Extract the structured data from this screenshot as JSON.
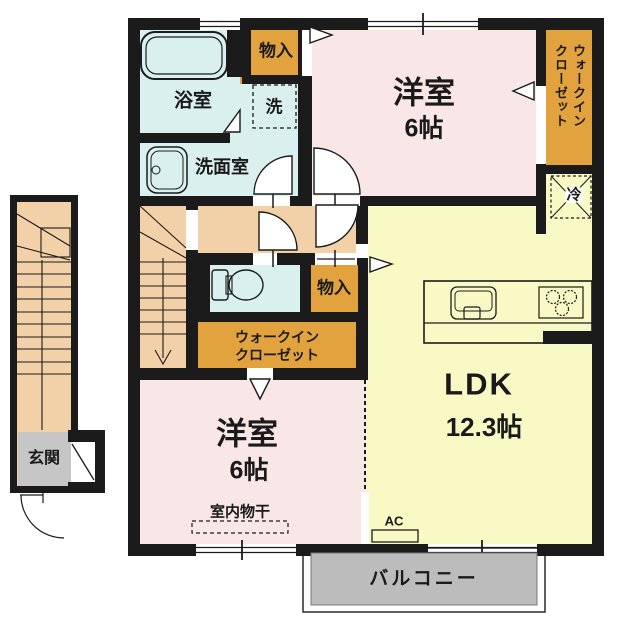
{
  "rooms": {
    "bathroom": {
      "label": "浴室"
    },
    "washer": {
      "label": "洗"
    },
    "storage_top": {
      "label": "物入"
    },
    "washroom": {
      "label": "洗面室"
    },
    "bedroom_top": {
      "name": "洋室",
      "size": "6帖"
    },
    "wic_top": {
      "label": "ウォークインクローゼット"
    },
    "fridge": {
      "label": "冷"
    },
    "storage_mid": {
      "label": "物入"
    },
    "wic_mid": {
      "line1": "ウォークイン",
      "line2": "クローゼット"
    },
    "ldk": {
      "name": "LDK",
      "size": "12.3帖"
    },
    "bedroom_bottom": {
      "name": "洋室",
      "size": "6帖",
      "note": "室内物干"
    },
    "entrance": {
      "label": "玄関"
    },
    "balcony": {
      "label": "バルコニー"
    },
    "ac": {
      "label": "AC"
    }
  },
  "colors": {
    "wall": "#1b1b1b",
    "bedroom_pink": "#f9e7e7",
    "ldk_yellow": "#f9f9c5",
    "wet_area_cyan": "#d9f0ee",
    "closet_orange": "#e2a33e",
    "hall_peach": "#f3d1a8",
    "balcony_gray": "#bcbcbc",
    "entrance_gray": "#c6c6c6"
  }
}
